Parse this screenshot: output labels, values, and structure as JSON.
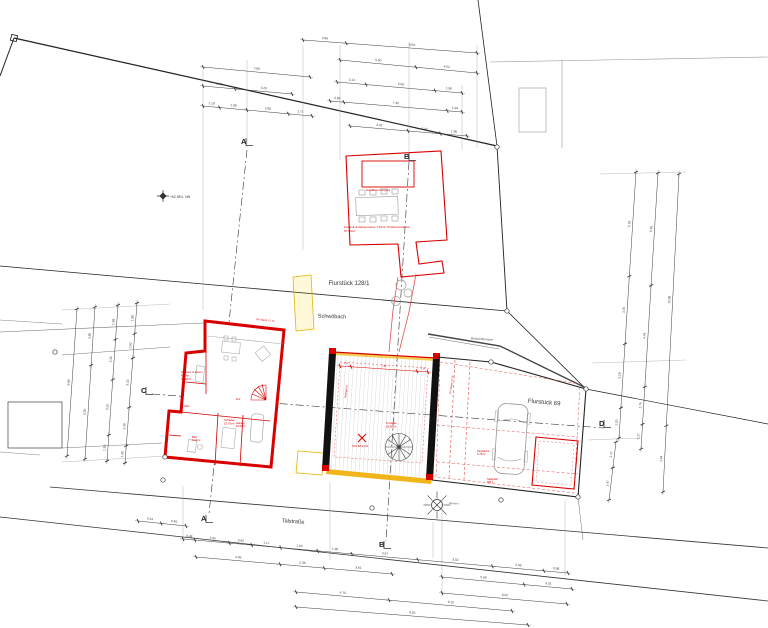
{
  "site": {
    "parcel_upper_label": "Flurstück 128/1",
    "parcel_right_label": "Flurstück 69",
    "stream_label": "Schwöbach",
    "street_label": "Talstraße"
  },
  "colors": {
    "ink": "#333333",
    "red": "#d90000",
    "red_light": "#e05050",
    "yellow": "#f0b400",
    "dim": "#3c3c3c",
    "gray": "#8a8a8a"
  },
  "sections": [
    {
      "id": "a-top",
      "letter": "A",
      "x": 241,
      "y": 144
    },
    {
      "id": "b-top",
      "letter": "B",
      "x": 404,
      "y": 159
    },
    {
      "id": "a-bottom",
      "letter": "A",
      "x": 201,
      "y": 521
    },
    {
      "id": "b-bottom",
      "letter": "B",
      "x": 379,
      "y": 547
    },
    {
      "id": "c-left",
      "letter": "C",
      "x": 141,
      "y": 393
    },
    {
      "id": "d-right",
      "letter": "D",
      "x": 599,
      "y": 426
    }
  ],
  "labels": [
    {
      "id": "bestandsmauer",
      "text": "Bestandsmauer",
      "x": 482,
      "y": 340,
      "size": 3.2,
      "color": "#555555",
      "rotate": 4,
      "anchor": "middle"
    },
    {
      "id": "benchmark",
      "text": "+62.98 ü. NN",
      "x": 170,
      "y": 198,
      "size": 3.4,
      "color": "#333333"
    },
    {
      "id": "pavilion-title",
      "text": "Geplante Pergola",
      "x": 366,
      "y": 191,
      "size": 3.1,
      "color": "#d90000"
    },
    {
      "id": "pavilion-note",
      "lines": [
        "Kiosk & Außenterrasse 7-Pers. Holzkonstruktion",
        "57.50m²"
      ],
      "x": 344,
      "y": 228,
      "size": 3.1,
      "lh": 4,
      "color": "#d90000"
    },
    {
      "id": "room-wohnen",
      "lines": [
        "Wohnen & Essen",
        "Küche",
        "32.50m²"
      ],
      "x": 181,
      "y": 373,
      "size": 2.8,
      "lh": 3.4,
      "color": "#d90000"
    },
    {
      "id": "room-schlafen",
      "lines": [
        "Schlafen",
        "13.75m²"
      ],
      "x": 224,
      "y": 421,
      "size": 2.8,
      "lh": 3.4,
      "color": "#d90000"
    },
    {
      "id": "room-bad",
      "lines": [
        "Bad",
        "6.20m²"
      ],
      "x": 192,
      "y": 438,
      "size": 2.7,
      "lh": 3.2,
      "color": "#d90000"
    },
    {
      "id": "room-abstell",
      "text": "Abst.",
      "x": 184,
      "y": 407,
      "size": 2.6,
      "color": "#d90000"
    },
    {
      "id": "room-flur",
      "text": "Flur",
      "x": 236,
      "y": 400,
      "size": 2.6,
      "color": "#d90000"
    },
    {
      "id": "room-garage",
      "lines": [
        "Garage",
        "18.00m²"
      ],
      "x": 236,
      "y": 424,
      "size": 2.6,
      "lh": 3.1,
      "color": "#d90000"
    },
    {
      "id": "court-terrasse",
      "lines": [
        "Terrasse",
        "28.60m²"
      ],
      "x": 386,
      "y": 424,
      "size": 2.8,
      "lh": 3.3,
      "color": "#d90000"
    },
    {
      "id": "level-mark",
      "text": "OK FFB ±0.00",
      "x": 352,
      "y": 447,
      "size": 2.5,
      "color": "#d90000"
    },
    {
      "id": "wall-note-top",
      "text": "OK Wand +2.75",
      "x": 256,
      "y": 320,
      "size": 2.6,
      "color": "#d90000",
      "rotate": 6
    },
    {
      "id": "wall-note-right",
      "text": "OK Mauer +2.35",
      "x": 451,
      "y": 394,
      "size": 2.5,
      "color": "#d90000",
      "rotate": -82
    },
    {
      "id": "wall-note-court",
      "text": "Rankgerüst",
      "x": 346,
      "y": 398,
      "size": 2.5,
      "color": "#d90000",
      "rotate": -83
    },
    {
      "id": "yard-kies",
      "lines": [
        "Kiesfläche",
        "5.75m²"
      ],
      "x": 477,
      "y": 452,
      "size": 2.7,
      "lh": 3.2,
      "color": "#d90000"
    },
    {
      "id": "yard-stellplatz",
      "lines": [
        "Stellplatz",
        "MB 1"
      ],
      "x": 487,
      "y": 480,
      "size": 2.7,
      "lh": 3.2,
      "color": "#d90000"
    },
    {
      "id": "tree-note",
      "text": "Bestand",
      "x": 449,
      "y": 504,
      "size": 2.6,
      "color": "#555555",
      "rotate": 3
    }
  ],
  "dim_chains": [
    {
      "x1": 303,
      "y1": 40,
      "x2": 477,
      "y2": 53,
      "values": [
        "2.86",
        "8.64"
      ]
    },
    {
      "x1": 203,
      "y1": 67,
      "x2": 310,
      "y2": 77,
      "values": [
        "7.86"
      ]
    },
    {
      "x1": 340,
      "y1": 60,
      "x2": 477,
      "y2": 73,
      "values": [
        "5.00",
        "4.02"
      ]
    },
    {
      "x1": 203,
      "y1": 86,
      "x2": 292,
      "y2": 94,
      "values": [
        "1.78",
        "3.20"
      ]
    },
    {
      "x1": 203,
      "y1": 106,
      "x2": 312,
      "y2": 116,
      "values": [
        "1.19",
        "1.98",
        "2.98",
        "1.71"
      ]
    },
    {
      "x1": 337,
      "y1": 82,
      "x2": 462,
      "y2": 93,
      "values": [
        "2.14",
        "5.06",
        "1.98"
      ]
    },
    {
      "x1": 330,
      "y1": 101,
      "x2": 462,
      "y2": 112,
      "values": [
        "0.98",
        "7.30",
        "1.04"
      ]
    },
    {
      "x1": 350,
      "y1": 126,
      "x2": 467,
      "y2": 136,
      "values": [
        "4.32",
        "2.42",
        "1.98"
      ]
    },
    {
      "x1": 77,
      "y1": 309,
      "x2": 67,
      "y2": 456,
      "values": [
        "9.85"
      ]
    },
    {
      "x1": 95,
      "y1": 307,
      "x2": 85,
      "y2": 459,
      "values": [
        "3.85",
        "6.20"
      ]
    },
    {
      "x1": 118,
      "y1": 305,
      "x2": 107,
      "y2": 461,
      "values": [
        "1.98",
        "2.32",
        "3.20",
        "1.50"
      ]
    },
    {
      "x1": 137,
      "y1": 303,
      "x2": 125,
      "y2": 463,
      "values": [
        "1.88",
        "1.50",
        "3.02",
        "2.36",
        "1.05"
      ]
    },
    {
      "x1": 636,
      "y1": 172,
      "x2": 619,
      "y2": 438,
      "values": [
        "5.18",
        "3.35",
        "3.18",
        "1.50"
      ]
    },
    {
      "x1": 658,
      "y1": 173,
      "x2": 641,
      "y2": 449,
      "values": [
        "5.30",
        "4.78",
        "1.76",
        "1.17"
      ]
    },
    {
      "x1": 679,
      "y1": 174,
      "x2": 663,
      "y2": 492,
      "values": [
        "13.08",
        "3.44"
      ]
    },
    {
      "x1": 616,
      "y1": 442,
      "x2": 609,
      "y2": 500,
      "values": [
        "1.17",
        "1.47"
      ]
    },
    {
      "x1": 138,
      "y1": 521,
      "x2": 186,
      "y2": 526,
      "values": [
        "0.43",
        "0.46"
      ]
    },
    {
      "x1": 183,
      "y1": 539,
      "x2": 568,
      "y2": 573,
      "values": [
        "0.48",
        "1.40",
        "0.90",
        "1.17",
        "1.50",
        "1.38",
        "2.67",
        "3.02",
        "2.08",
        "0.98"
      ]
    },
    {
      "x1": 196,
      "y1": 557,
      "x2": 392,
      "y2": 574,
      "values": [
        "4.48",
        "2.36",
        "3.61"
      ]
    },
    {
      "x1": 442,
      "y1": 577,
      "x2": 572,
      "y2": 589,
      "values": [
        "5.69",
        "3.31"
      ]
    },
    {
      "x1": 442,
      "y1": 593,
      "x2": 567,
      "y2": 604,
      "values": [
        "9.00"
      ]
    },
    {
      "x1": 296,
      "y1": 592,
      "x2": 512,
      "y2": 611,
      "values": [
        "4.70",
        "6.20"
      ]
    },
    {
      "x1": 296,
      "y1": 607,
      "x2": 528,
      "y2": 625,
      "values": [
        "9.20"
      ]
    },
    {
      "x1": 340,
      "y1": 366,
      "x2": 428,
      "y2": 372,
      "values": [
        "1.14",
        "6.85",
        "1.14"
      ],
      "color": "#d90000",
      "fs": 2.4
    }
  ],
  "survey_points": [
    [
      497,
      147
    ],
    [
      507,
      311
    ],
    [
      491,
      362
    ],
    [
      586,
      389
    ],
    [
      578,
      497
    ],
    [
      501,
      500
    ],
    [
      163,
      480
    ],
    [
      372,
      508
    ],
    [
      55,
      352
    ],
    [
      165,
      457
    ]
  ],
  "trees": [
    {
      "x": 437,
      "y": 505,
      "r": 5.5,
      "rays": 8,
      "color": "#333333"
    },
    {
      "x": 401,
      "y": 285,
      "r": 5,
      "rays": 0,
      "color": "#999999"
    },
    {
      "x": 408,
      "y": 293,
      "r": 4,
      "rays": 0,
      "color": "#999999"
    },
    {
      "x": 396,
      "y": 301,
      "r": 4.5,
      "rays": 0,
      "color": "#999999"
    }
  ]
}
